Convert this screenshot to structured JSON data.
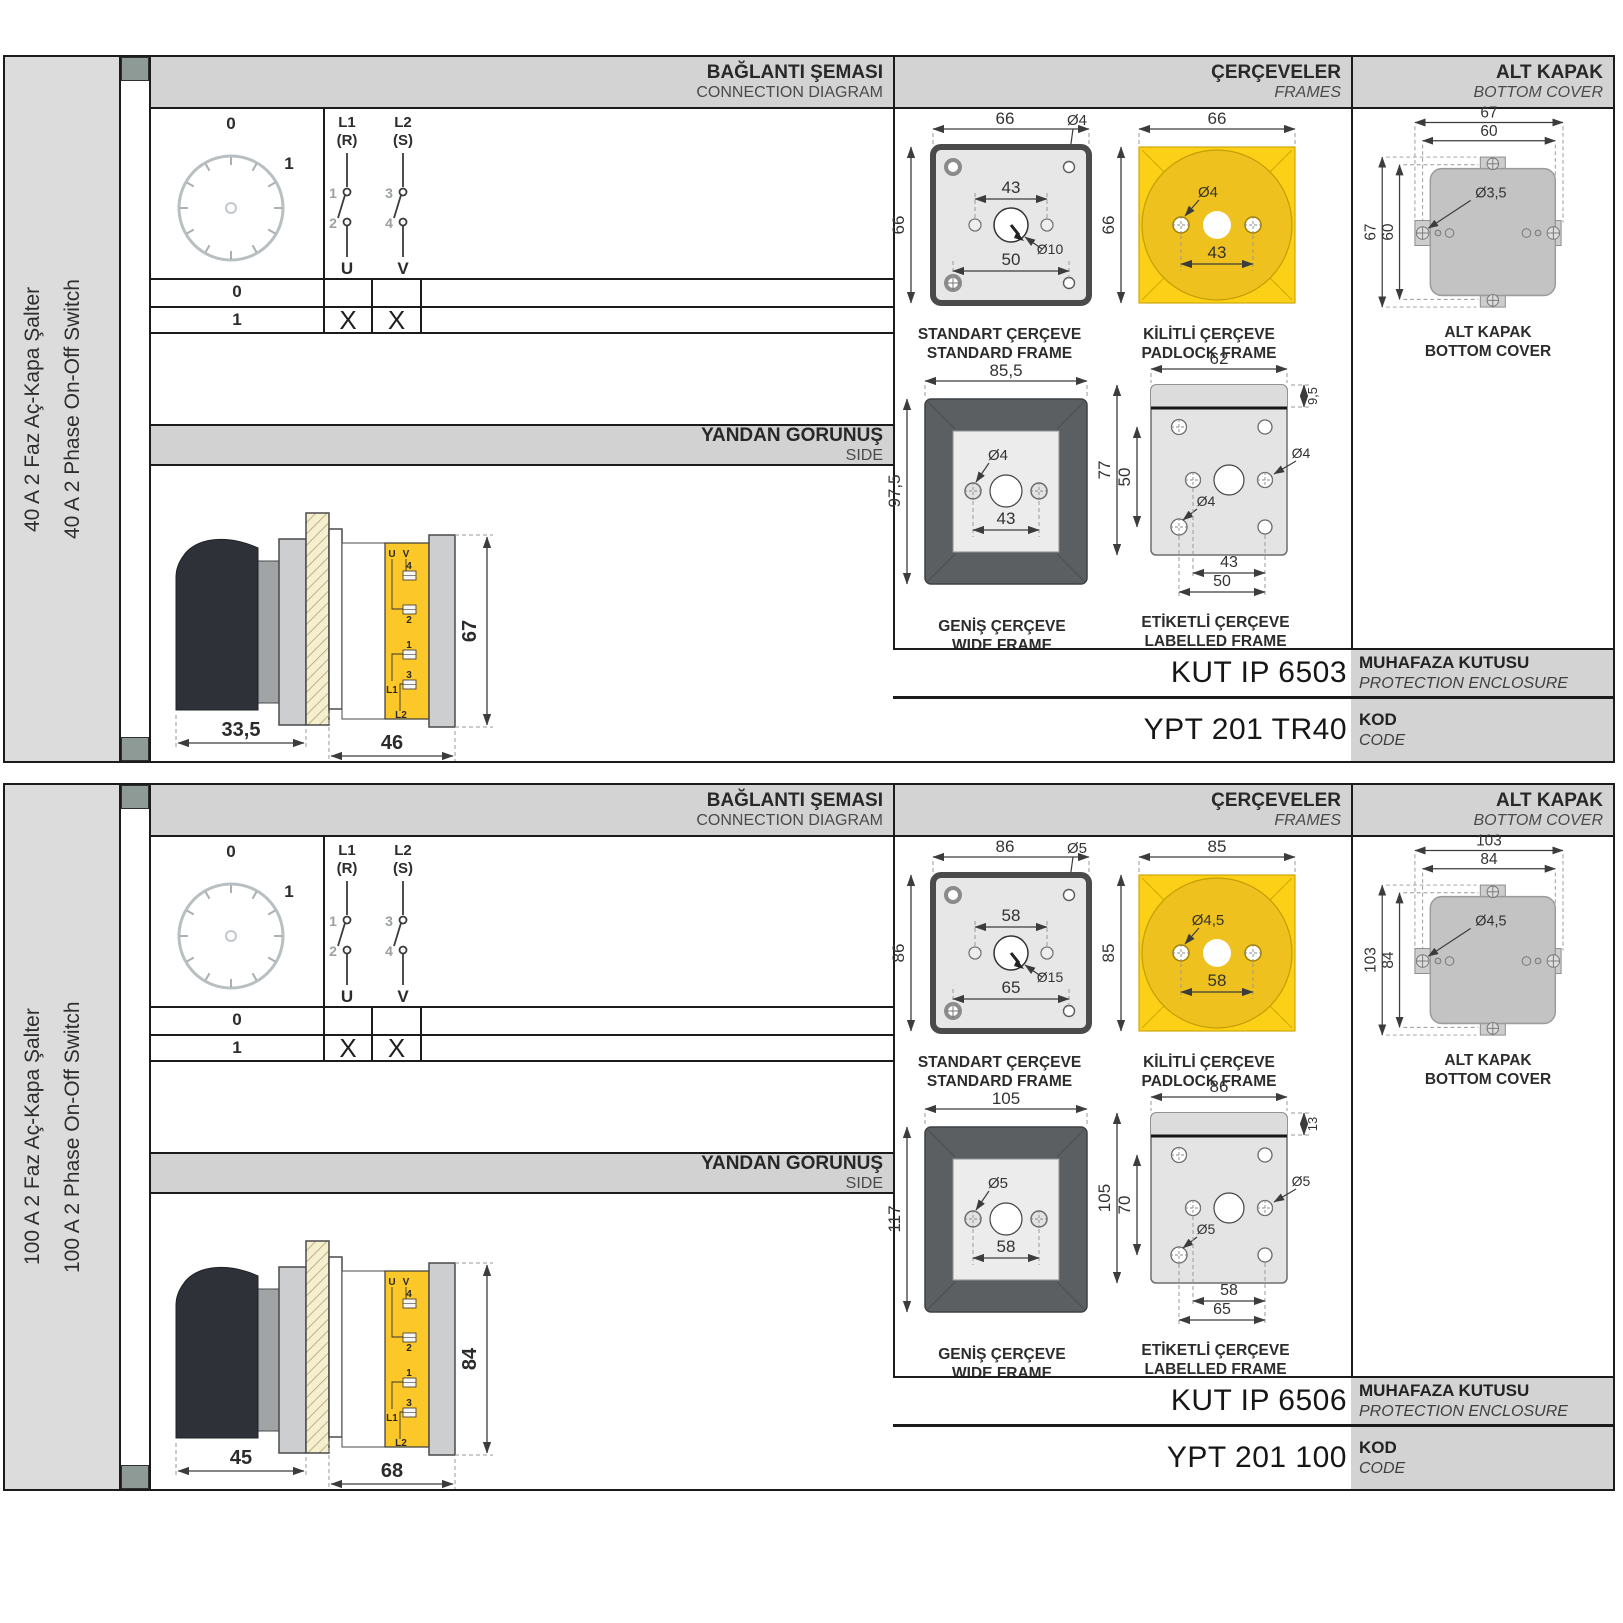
{
  "colors": {
    "border": "#1b1b1b",
    "panel_gray": "#d3d3d3",
    "sidebar_gray": "#dcdcdc",
    "mark_green": "#8e9a96",
    "frame_yellow": "#fbd016",
    "padlock_circle_yellow": "#eec11e",
    "switch_body_yellow": "#fcc829",
    "wide_frame_dark": "#5b5f62",
    "cover_gray": "#c3c3c3"
  },
  "terms": {
    "u": "U",
    "v": "V",
    "t1": "1",
    "t2": "2",
    "t3": "3",
    "t4": "4",
    "l1": "L1",
    "l2": "L2"
  },
  "sections": [
    {
      "sidebar": {
        "tr": "40 A 2 Faz Aç-Kapa Şalter",
        "en": "40 A 2 Phase On-Off Switch"
      },
      "headers": {
        "diagram_tr": "BAĞLANTI ŞEMASI",
        "diagram_en": "CONNECTION DIAGRAM",
        "frames_tr": "ÇERÇEVELER",
        "frames_en": "FRAMES",
        "cover_tr": "ALT KAPAK",
        "cover_en": "BOTTOM COVER"
      },
      "diagram": {
        "pos0": "0",
        "pos1": "1",
        "p1_top": "L1",
        "p1_sub": "(R)",
        "p2_top": "L2",
        "p2_sub": "(S)",
        "n1": "1",
        "n2": "2",
        "n3": "3",
        "n4": "4",
        "u": "U",
        "v": "V",
        "row0": "0",
        "row1": "1",
        "x1": "X",
        "x2": "X"
      },
      "side": {
        "tr": "YANDAN GÖRÜNÜŞ",
        "en": "SIDE",
        "dim_a": "33,5",
        "dim_b": "46",
        "dim_h": "67"
      },
      "std": {
        "w": "66",
        "h": "66",
        "hole": "Ø4",
        "mid": "43",
        "center": "Ø10",
        "bottom": "50",
        "tr": "STANDART ÇERÇEVE",
        "en": "STANDARD FRAME"
      },
      "pad": {
        "w": "66",
        "h": "66",
        "hole": "Ø4",
        "mid": "43",
        "tr": "KİLİTLİ ÇERÇEVE",
        "en": "PADLOCK FRAME"
      },
      "wide": {
        "w": "85,5",
        "h": "97,5",
        "hole": "Ø4",
        "mid": "43",
        "tr": "GENİŞ ÇERÇEVE",
        "en": "WIDE FRAME"
      },
      "lab": {
        "w": "62",
        "strip": "9,5",
        "h": "77",
        "span": "50",
        "hole_r": "Ø4",
        "hole_b": "Ø4",
        "dim1": "43",
        "dim2": "50",
        "tr": "ETİKETLİ ÇERÇEVE",
        "en": "LABELLED FRAME"
      },
      "cover": {
        "ow": "67",
        "iw": "60",
        "oh": "67",
        "ih": "60",
        "hole": "Ø3,5",
        "tr": "ALT KAPAK",
        "en": "BOTTOM COVER"
      },
      "enc": {
        "value": "KUT IP 6503",
        "tr": "MUHAFAZA KUTUSU",
        "en": "PROTECTION ENCLOSURE"
      },
      "code": {
        "value": "YPT 201 TR40",
        "tr": "KOD",
        "en": "CODE"
      }
    },
    {
      "sidebar": {
        "tr": "100 A 2 Faz Aç-Kapa Şalter",
        "en": "100 A 2 Phase On-Off Switch"
      },
      "headers": {
        "diagram_tr": "BAĞLANTI ŞEMASI",
        "diagram_en": "CONNECTION DIAGRAM",
        "frames_tr": "ÇERÇEVELER",
        "frames_en": "FRAMES",
        "cover_tr": "ALT KAPAK",
        "cover_en": "BOTTOM COVER"
      },
      "diagram": {
        "pos0": "0",
        "pos1": "1",
        "p1_top": "L1",
        "p1_sub": "(R)",
        "p2_top": "L2",
        "p2_sub": "(S)",
        "n1": "1",
        "n2": "2",
        "n3": "3",
        "n4": "4",
        "u": "U",
        "v": "V",
        "row0": "0",
        "row1": "1",
        "x1": "X",
        "x2": "X"
      },
      "side": {
        "tr": "YANDAN GÖRÜNÜŞ",
        "en": "SIDE",
        "dim_a": "45",
        "dim_b": "68",
        "dim_h": "84"
      },
      "std": {
        "w": "86",
        "h": "86",
        "hole": "Ø5",
        "mid": "58",
        "center": "Ø15",
        "bottom": "65",
        "tr": "STANDART ÇERÇEVE",
        "en": "STANDARD FRAME"
      },
      "pad": {
        "w": "85",
        "h": "85",
        "hole": "Ø4,5",
        "mid": "58",
        "tr": "KİLİTLİ ÇERÇEVE",
        "en": "PADLOCK FRAME"
      },
      "wide": {
        "w": "105",
        "h": "117",
        "hole": "Ø5",
        "mid": "58",
        "tr": "GENİŞ ÇERÇEVE",
        "en": "WIDE FRAME"
      },
      "lab": {
        "w": "86",
        "strip": "13",
        "h": "105",
        "span": "70",
        "hole_r": "Ø5",
        "hole_b": "Ø5",
        "dim1": "58",
        "dim2": "65",
        "tr": "ETİKETLİ ÇERÇEVE",
        "en": "LABELLED FRAME"
      },
      "cover": {
        "ow": "103",
        "iw": "84",
        "oh": "103",
        "ih": "84",
        "hole": "Ø4,5",
        "tr": "ALT KAPAK",
        "en": "BOTTOM COVER"
      },
      "enc": {
        "value": "KUT IP 6506",
        "tr": "MUHAFAZA KUTUSU",
        "en": "PROTECTION ENCLOSURE"
      },
      "code": {
        "value": "YPT 201 100",
        "tr": "KOD",
        "en": "CODE"
      }
    }
  ]
}
